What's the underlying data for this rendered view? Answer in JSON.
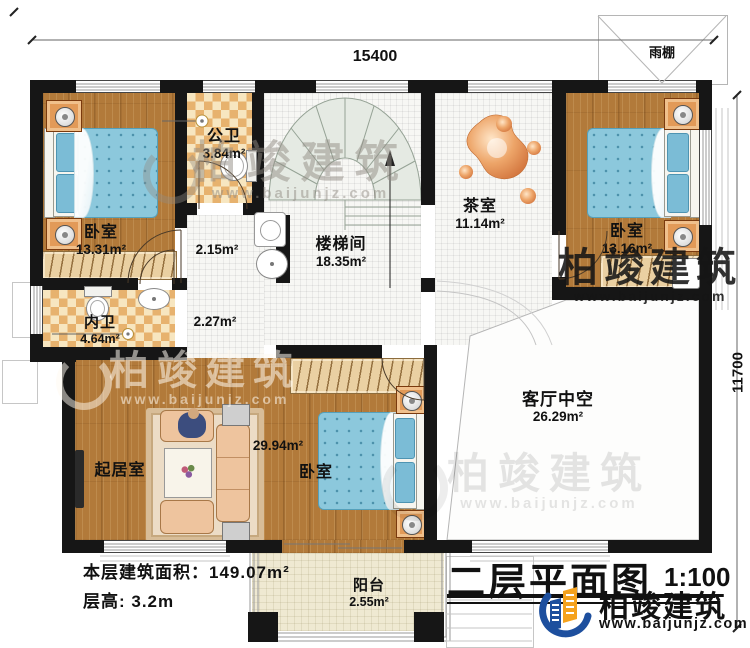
{
  "plan": {
    "dimensions": {
      "top": "15400",
      "right": "11700"
    },
    "canopy_label": "雨棚",
    "rooms": {
      "bedroom_nw": {
        "name": "卧室",
        "area": "13.31m²"
      },
      "public_bath": {
        "name": "公卫",
        "area": "3.84m²"
      },
      "laundry_nook": {
        "area": "2.15m²"
      },
      "hallway": {
        "area": "2.27m²"
      },
      "stairwell": {
        "name": "楼梯间",
        "area": "18.35m²"
      },
      "tea_room": {
        "name": "茶室",
        "area": "11.14m²"
      },
      "bedroom_ne": {
        "name": "卧室",
        "area": "13.16m²"
      },
      "private_bath": {
        "name": "内卫",
        "area": "4.64m²"
      },
      "living_room": {
        "name": "起居室"
      },
      "bedroom_s": {
        "name": "卧室",
        "area": "29.94m²"
      },
      "void_above_living": {
        "name": "客厅中空",
        "area": "26.29m²"
      },
      "balcony": {
        "name": "阳台",
        "area": "2.55m²"
      }
    },
    "notes": {
      "floor_area": "本层建筑面积：149.07m²",
      "floor_height": "层高: 3.2m"
    },
    "title_block": {
      "title": "二层平面图",
      "scale": "1:100"
    },
    "brand": {
      "name": "柏竣建筑",
      "website": "www.baijunjz.com"
    },
    "watermark": {
      "text": "柏竣建筑",
      "url": "www.baijunjz.com"
    },
    "colors": {
      "wall": "#161616",
      "wood_floor": "#b27a3a",
      "checker_tile": "#e7b26e",
      "bed_blue": "#8cc8dc",
      "nightstand_orange": "#e29a58",
      "stair_gray": "#e5eae3",
      "balcony_floor": "#efe9d2",
      "brand_blue": "#1d4f9e",
      "brand_orange": "#f5a21d"
    }
  }
}
